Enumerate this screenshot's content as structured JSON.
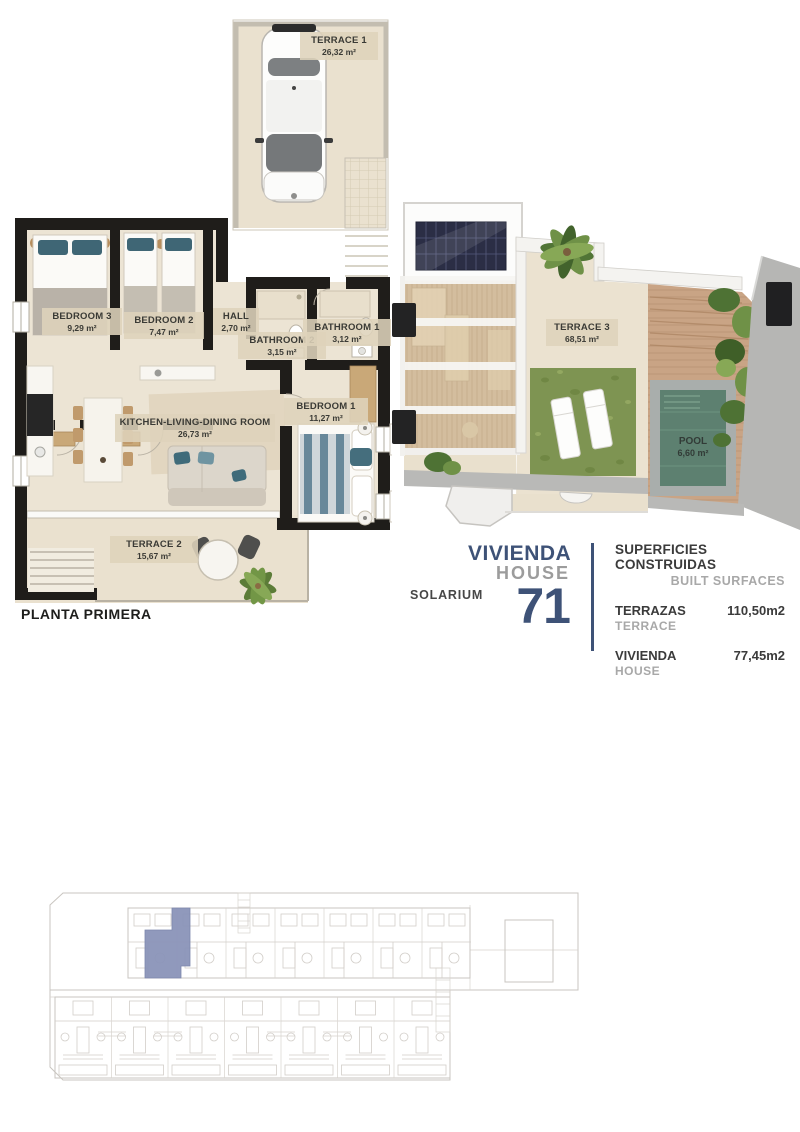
{
  "floor_plan": {
    "title": "PLANTA PRIMERA",
    "rooms": [
      {
        "label": "TERRACE 1",
        "area": "26,32 m²"
      },
      {
        "label": "BEDROOM 3",
        "area": "9,29 m²"
      },
      {
        "label": "BEDROOM 2",
        "area": "7,47 m²"
      },
      {
        "label": "HALL",
        "area": "2,70 m²"
      },
      {
        "label": "BATHROOM 2",
        "area": "3,15 m²"
      },
      {
        "label": "BATHROOM 1",
        "area": "3,12 m²"
      },
      {
        "label": "KITCHEN-LIVING-DINING ROOM",
        "area": "26,73 m²"
      },
      {
        "label": "BEDROOM 1",
        "area": "11,27 m²"
      },
      {
        "label": "TERRACE 2",
        "area": "15,67 m²"
      }
    ]
  },
  "solarium_plan": {
    "title": "SOLARIUM",
    "rooms": [
      {
        "label": "TERRACE 3",
        "area": "68,51 m²"
      },
      {
        "label": "POOL",
        "area": "6,60 m²"
      }
    ]
  },
  "unit_card": {
    "name_es": "VIVIENDA",
    "name_en": "HOUSE",
    "number": "71"
  },
  "surfaces": {
    "title_es": "SUPERFICIES CONSTRUIDAS",
    "title_en": "BUILT SURFACES",
    "rows": [
      {
        "label_es": "TERRAZAS",
        "label_en": "TERRACE",
        "value": "110,50m2"
      },
      {
        "label_es": "VIVIENDA",
        "label_en": "HOUSE",
        "value": "77,45m2"
      }
    ]
  },
  "colors": {
    "accent_navy": "#3e5277",
    "muted_gray": "#9c9c9c",
    "site_highlight": "#8a93b8",
    "wall_black": "#1f1d1a",
    "floor_beige": "#ece4d4",
    "grass_green": "#7e9452",
    "pool_water": "#5d8070"
  }
}
